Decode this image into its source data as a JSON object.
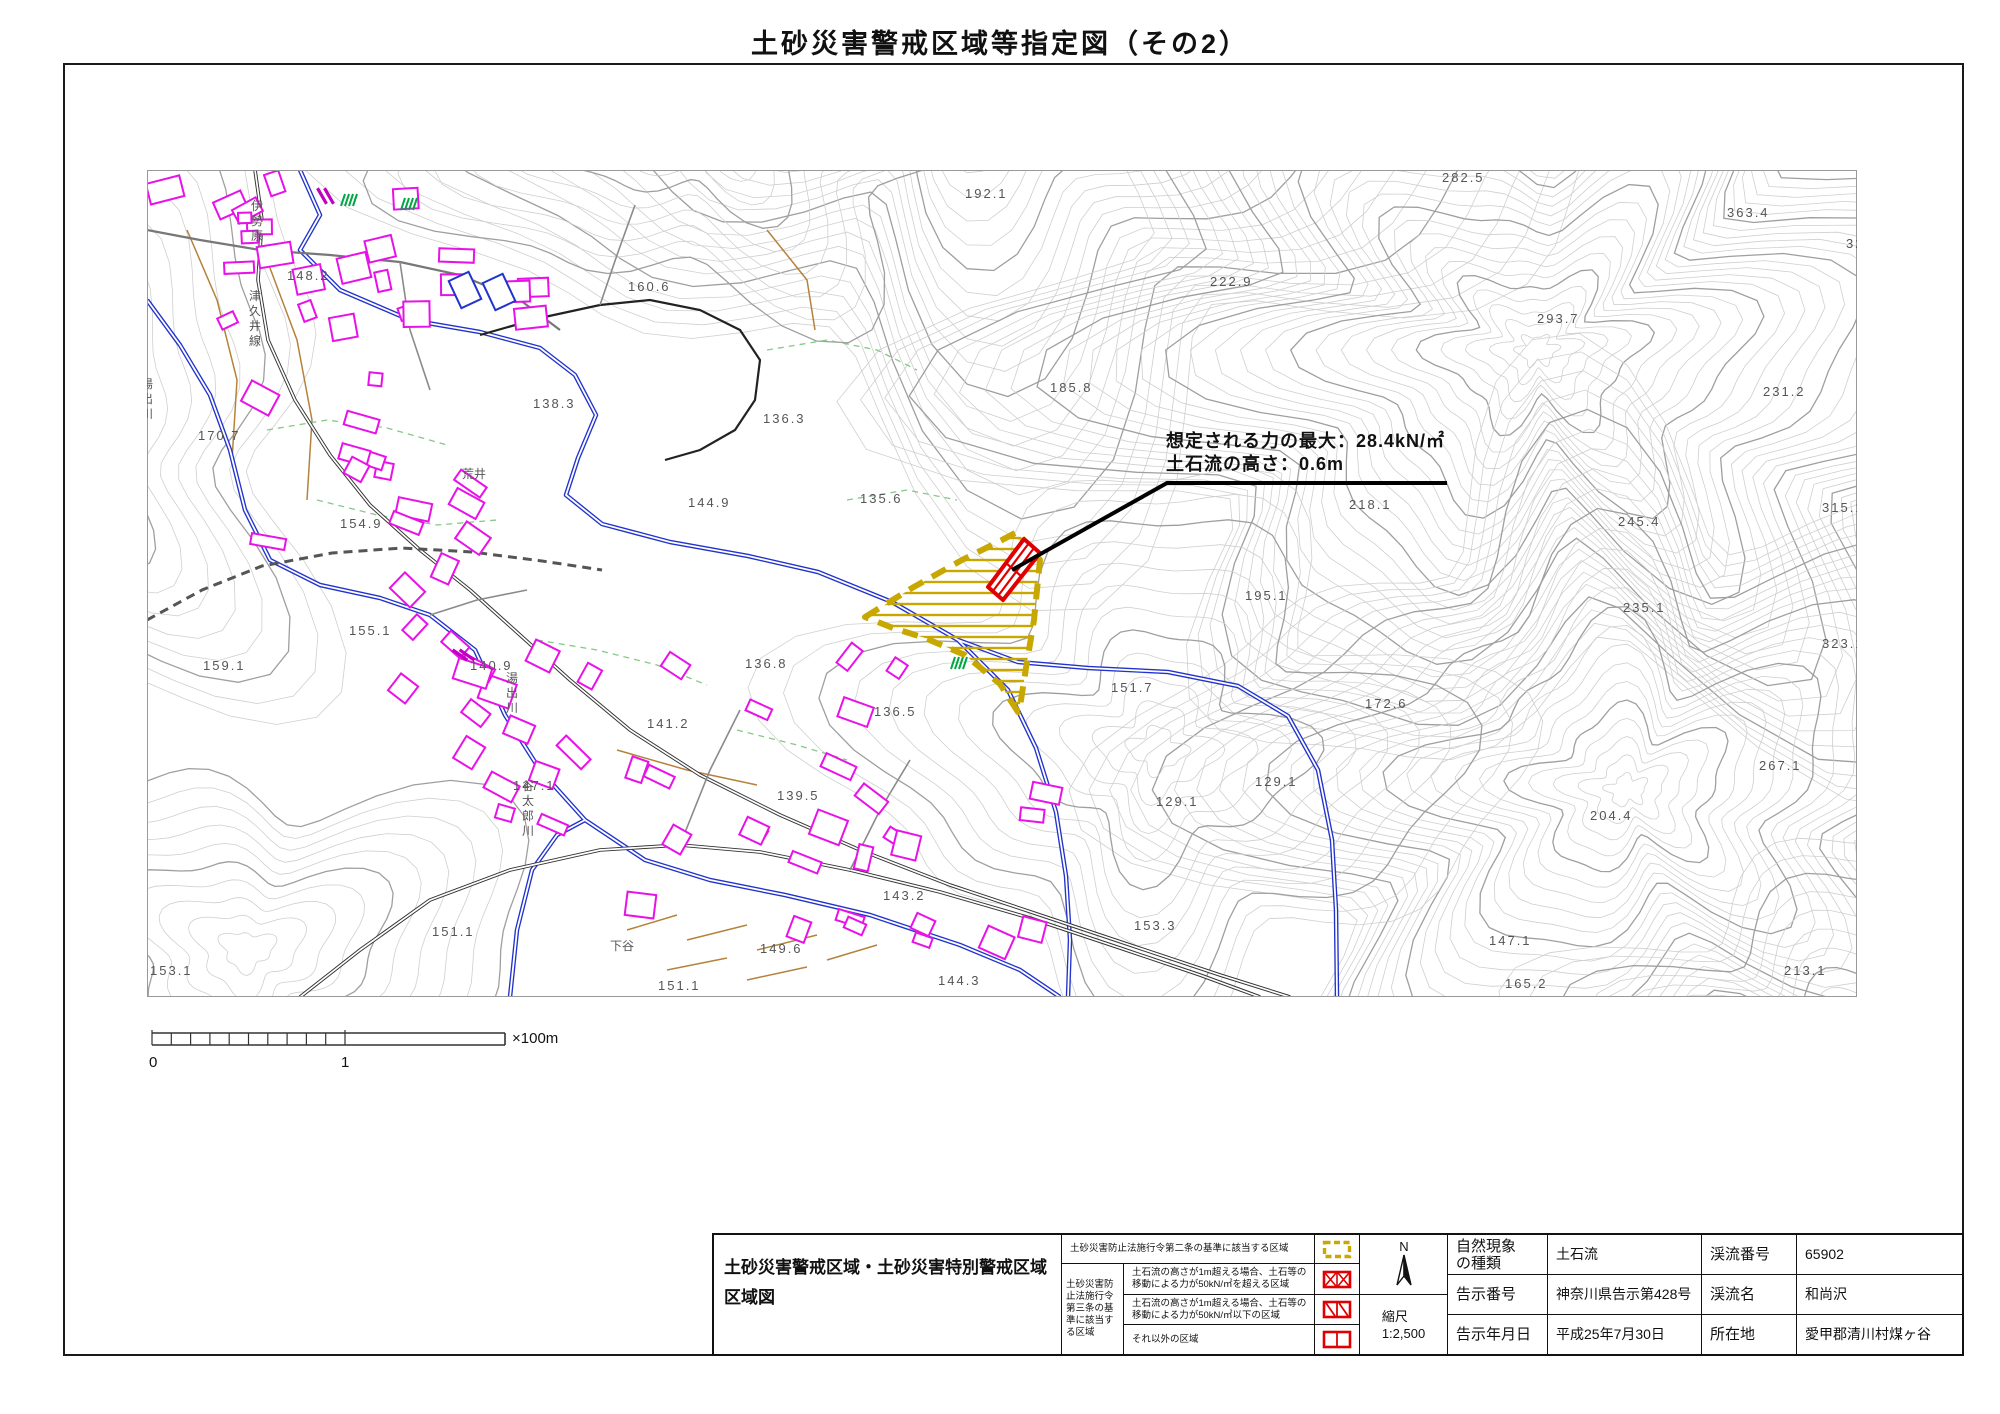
{
  "title": "土砂災害警戒区域等指定図（その2）",
  "annotation": {
    "line1": "想定される力の最大：28.4kN/㎡",
    "line2": "土石流の高さ：0.6m"
  },
  "scale_bar": {
    "zero": "0",
    "one": "1",
    "unit": "×100m"
  },
  "map": {
    "elevation_labels": [
      {
        "v": "282.5",
        "x": 1442,
        "y": 182
      },
      {
        "v": "192.1",
        "x": 965,
        "y": 198
      },
      {
        "v": "363.4",
        "x": 1727,
        "y": 217
      },
      {
        "v": "324.3",
        "x": 1846,
        "y": 248
      },
      {
        "v": "160.6",
        "x": 628,
        "y": 291
      },
      {
        "v": "222.9",
        "x": 1210,
        "y": 286
      },
      {
        "v": "293.7",
        "x": 1537,
        "y": 323
      },
      {
        "v": "138.3",
        "x": 533,
        "y": 408
      },
      {
        "v": "185.8",
        "x": 1050,
        "y": 392
      },
      {
        "v": "231.2",
        "x": 1763,
        "y": 396
      },
      {
        "v": "136.3",
        "x": 763,
        "y": 423
      },
      {
        "v": "170.7",
        "x": 198,
        "y": 440
      },
      {
        "v": "218.1",
        "x": 1349,
        "y": 509
      },
      {
        "v": "245.4",
        "x": 1618,
        "y": 526
      },
      {
        "v": "315.1",
        "x": 1822,
        "y": 512
      },
      {
        "v": "144.9",
        "x": 688,
        "y": 507
      },
      {
        "v": "135.6",
        "x": 860,
        "y": 503
      },
      {
        "v": "154.9",
        "x": 340,
        "y": 528
      },
      {
        "v": "195.1",
        "x": 1245,
        "y": 600
      },
      {
        "v": "235.1",
        "x": 1623,
        "y": 612
      },
      {
        "v": "155.1",
        "x": 349,
        "y": 635
      },
      {
        "v": "323.1",
        "x": 1822,
        "y": 648
      },
      {
        "v": "159.1",
        "x": 203,
        "y": 670
      },
      {
        "v": "151.7",
        "x": 1111,
        "y": 692
      },
      {
        "v": "172.6",
        "x": 1365,
        "y": 708
      },
      {
        "v": "140.9",
        "x": 470,
        "y": 670
      },
      {
        "v": "136.8",
        "x": 745,
        "y": 668
      },
      {
        "v": "136.5",
        "x": 874,
        "y": 716
      },
      {
        "v": "267.1",
        "x": 1759,
        "y": 770
      },
      {
        "v": "129.1",
        "x": 1255,
        "y": 786
      },
      {
        "v": "129.1",
        "x": 1156,
        "y": 806
      },
      {
        "v": "204.4",
        "x": 1590,
        "y": 820
      },
      {
        "v": "147.1",
        "x": 513,
        "y": 790
      },
      {
        "v": "141.2",
        "x": 647,
        "y": 728
      },
      {
        "v": "143.2",
        "x": 883,
        "y": 900
      },
      {
        "v": "153.3",
        "x": 1134,
        "y": 930
      },
      {
        "v": "151.1",
        "x": 432,
        "y": 936
      },
      {
        "v": "213.1",
        "x": 1784,
        "y": 975
      },
      {
        "v": "149.6",
        "x": 760,
        "y": 953
      },
      {
        "v": "139.5",
        "x": 777,
        "y": 800
      },
      {
        "v": "147.1",
        "x": 1489,
        "y": 945
      },
      {
        "v": "165.2",
        "x": 1505,
        "y": 988
      },
      {
        "v": "144.3",
        "x": 938,
        "y": 985
      },
      {
        "v": "151.1",
        "x": 658,
        "y": 990
      },
      {
        "v": "153.1",
        "x": 150,
        "y": 975
      },
      {
        "v": "148.2",
        "x": 287,
        "y": 280
      }
    ],
    "place_labels": [
      {
        "t": "主要地方道",
        "x": 205,
        "y": 95,
        "mode": "d"
      },
      {
        "t": "伊勢原",
        "x": 251,
        "y": 210,
        "mode": "v"
      },
      {
        "t": "津久井線",
        "x": 249,
        "y": 300,
        "mode": "v"
      },
      {
        "t": "湯出川",
        "x": 141,
        "y": 388,
        "mode": "v"
      },
      {
        "t": "湯出川",
        "x": 506,
        "y": 682,
        "mode": "v"
      },
      {
        "t": "谷太郎川",
        "x": 522,
        "y": 790,
        "mode": "v"
      },
      {
        "t": "荒井",
        "x": 462,
        "y": 478,
        "mode": "h"
      },
      {
        "t": "下谷",
        "x": 610,
        "y": 950,
        "mode": "h"
      }
    ]
  },
  "legend": {
    "map_title_line1": "土砂災害警戒区域・土砂災害特別警戒区域",
    "map_title_line2": "区域図",
    "row1": "土砂災害防止法施行令第二条の基準に該当する区域",
    "subheader": "土砂災害防止法施行令第三条の基準に該当する区域",
    "row2_line1": "土石流の高さが1m超える場合、土石等の",
    "row2_line2": "移動による力が50kN/㎡を超える区域",
    "row3_line1": "土石流の高さが1m超える場合、土石等の",
    "row3_line2": "移動による力が50kN/㎡以下の区域",
    "row4": "それ以外の区域",
    "north_label": "N",
    "scale_label": "縮尺",
    "scale_value": "1:2,500"
  },
  "info": {
    "r1c1": "自然現象",
    "r1c1b": "の種類",
    "r1c2": "土石流",
    "r1c3": "渓流番号",
    "r1c4": "65902",
    "r2c1": "告示番号",
    "r2c2": "神奈川県告示第428号",
    "r2c3": "渓流名",
    "r2c4": "和尚沢",
    "r3c1": "告示年月日",
    "r3c2": "平成25年7月30日",
    "r3c3": "所在地",
    "r3c4": "愛甲郡清川村煤ヶ谷"
  },
  "colors": {
    "building": "#e812e8",
    "river": "#2233cc",
    "contour": "#cfcfcf",
    "contour_major": "#9f9f9f",
    "warning": "#c8a800",
    "special": "#e00000",
    "vegetation": "#86c886",
    "terrain_brown": "#b5823c",
    "dam_green": "#00a844"
  }
}
